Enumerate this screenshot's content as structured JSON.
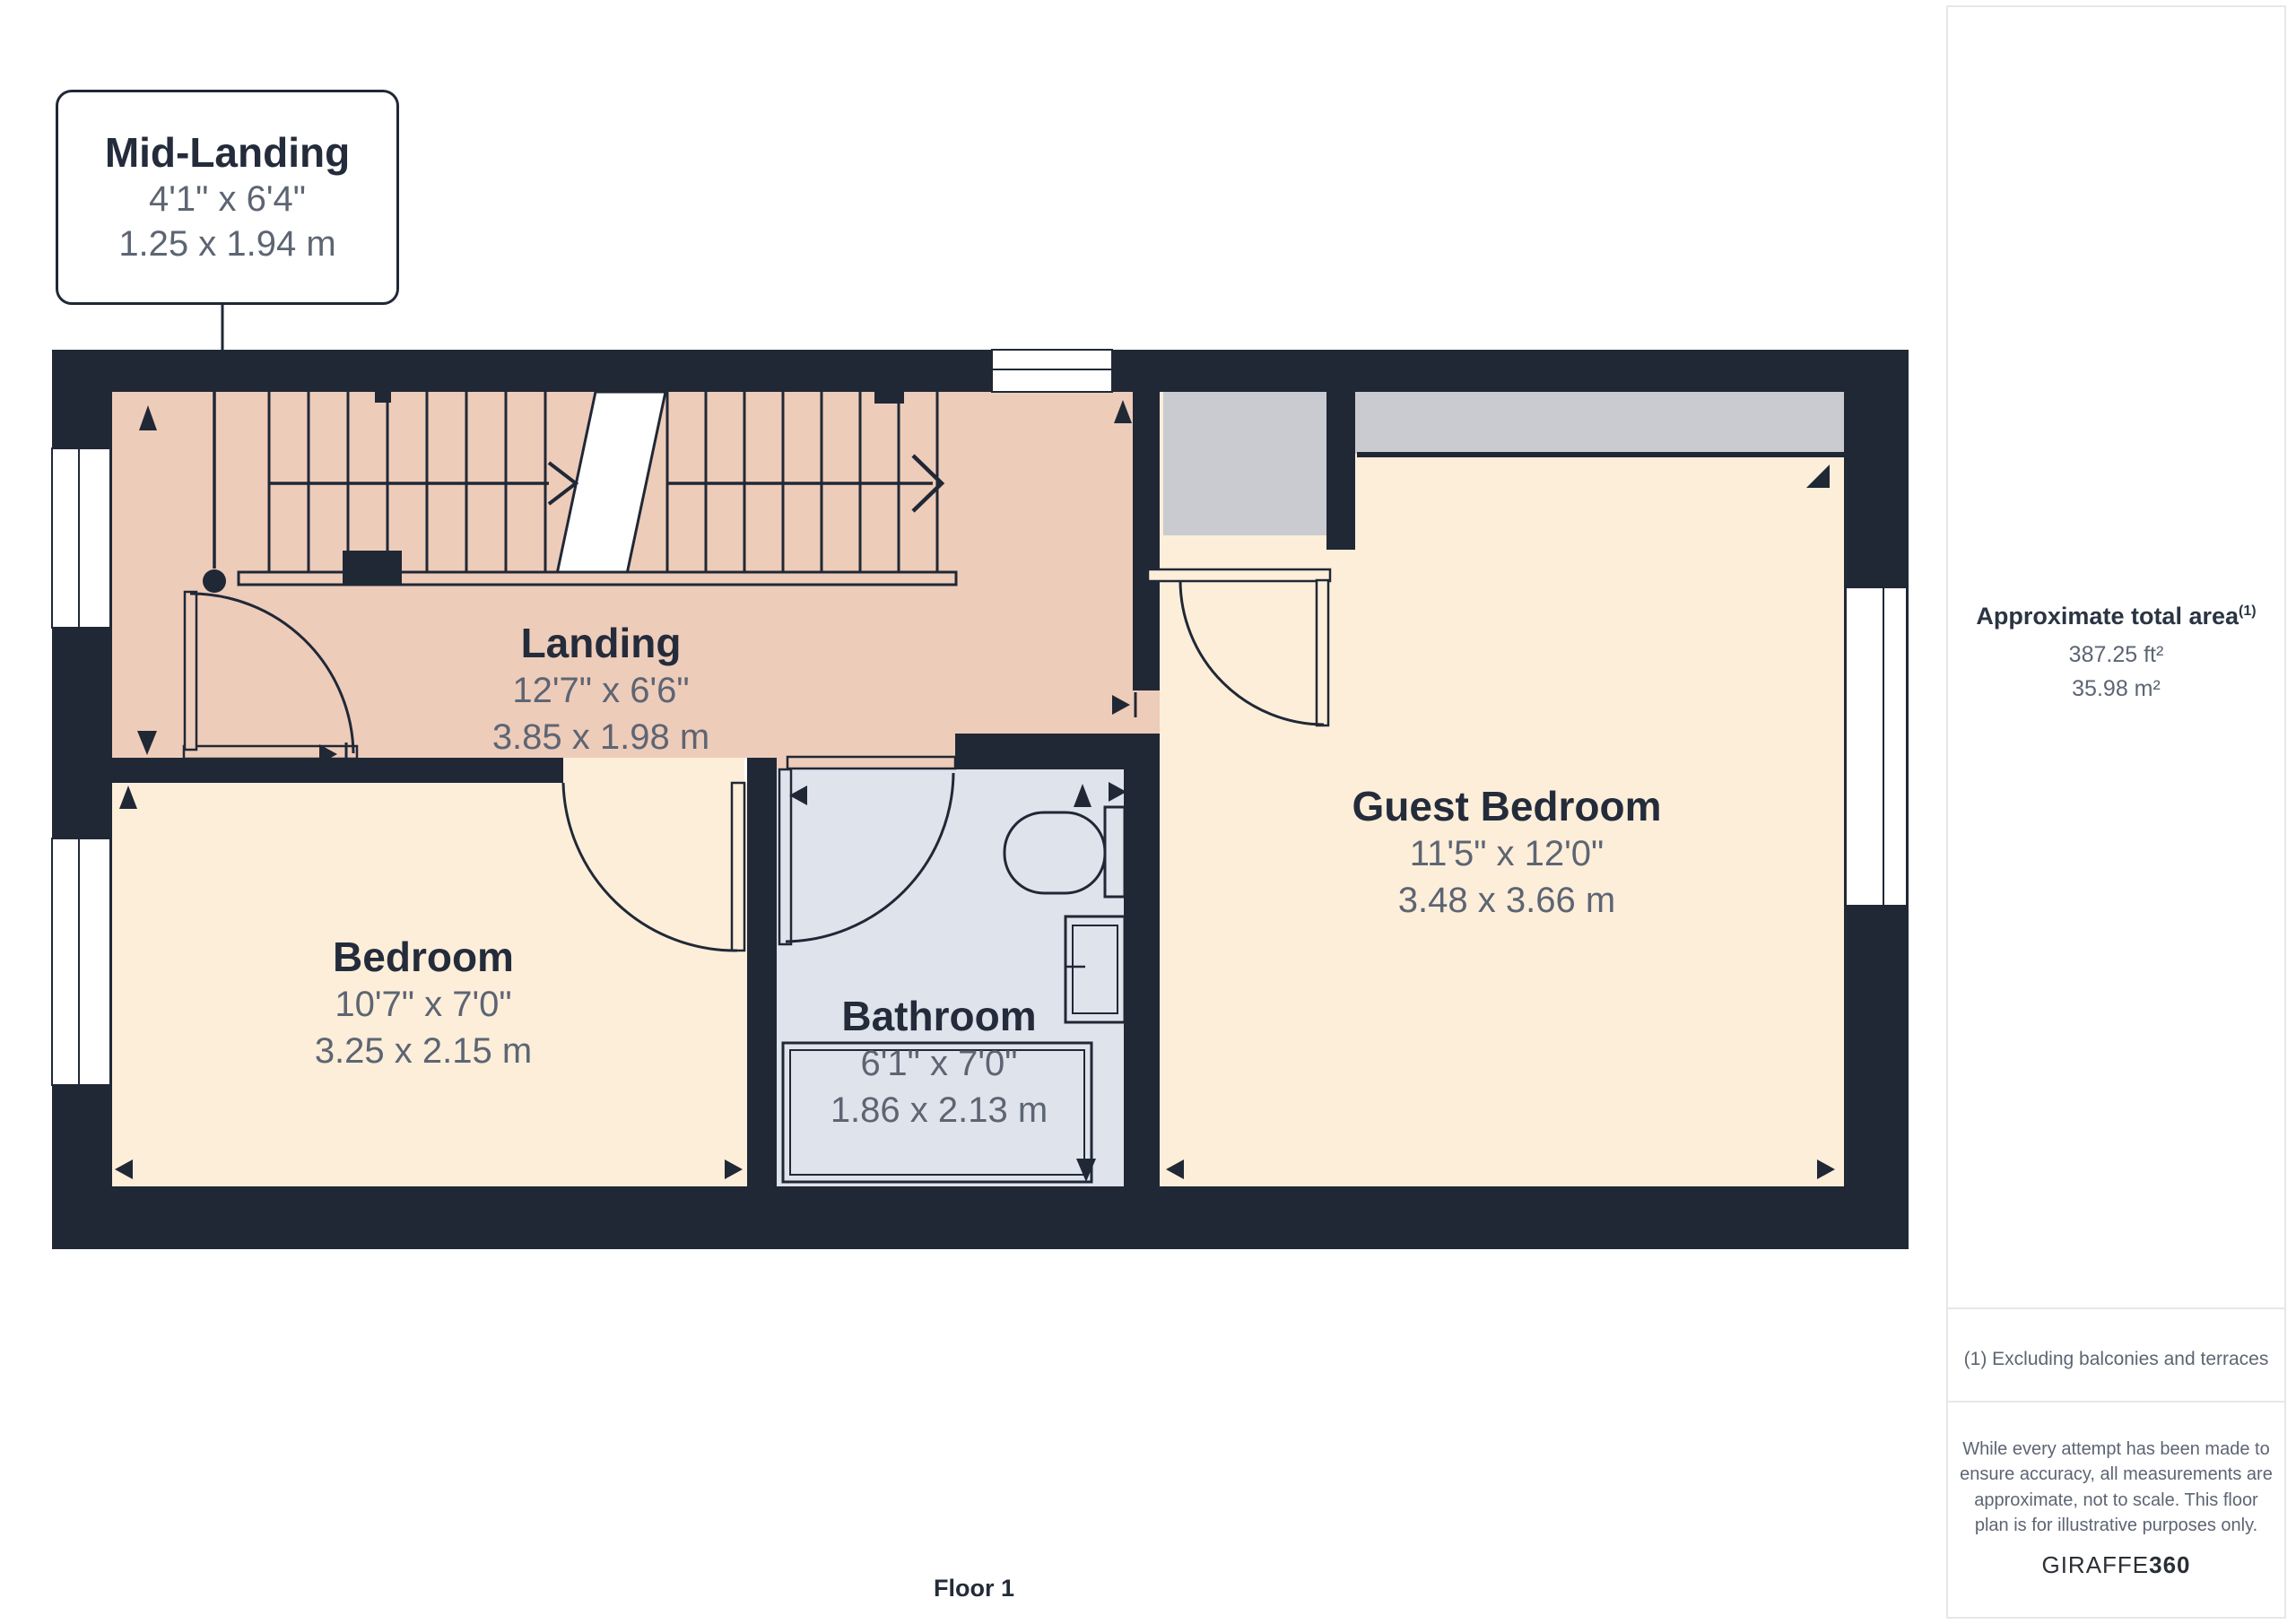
{
  "page": {
    "floor_label": "Floor 1"
  },
  "callout": {
    "title": "Mid-Landing",
    "dims_imperial": "4'1\" x 6'4\"",
    "dims_metric": "1.25 x 1.94 m"
  },
  "rooms": [
    {
      "name": "Landing",
      "dims_imperial": "12'7\" x 6'6\"",
      "dims_metric": "3.85 x 1.98 m"
    },
    {
      "name": "Bedroom",
      "dims_imperial": "10'7\" x 7'0\"",
      "dims_metric": "3.25 x 2.15 m"
    },
    {
      "name": "Bathroom",
      "dims_imperial": "6'1\" x 7'0\"",
      "dims_metric": "1.86 x 2.13 m"
    },
    {
      "name": "Guest Bedroom",
      "dims_imperial": "11'5\" x 12'0\"",
      "dims_metric": "3.48 x 3.66 m"
    }
  ],
  "sidebar": {
    "area_title": "Approximate total area",
    "area_title_sup": "(1)",
    "area_ft": "387.25 ft²",
    "area_m": "35.98 m²",
    "footnote": "(1) Excluding balconies and terraces",
    "disclaimer_lines": [
      "While every attempt has been made to",
      "ensure accuracy, all measurements are",
      "approximate, not to scale. This floor",
      "plan is for illustrative purposes only."
    ],
    "brand_name": "GIRAFFE",
    "brand_suffix": "360"
  },
  "colors": {
    "wall": "#202836",
    "landing_floor": "#eeccba",
    "bedroom_floor": "#fdeeda",
    "bathroom_floor": "#dfe3ec",
    "closet_grey": "#c9cbd1",
    "title_text": "#242c3b",
    "dim_text": "#5d6573",
    "sidebar_border": "#e7e7e7"
  }
}
